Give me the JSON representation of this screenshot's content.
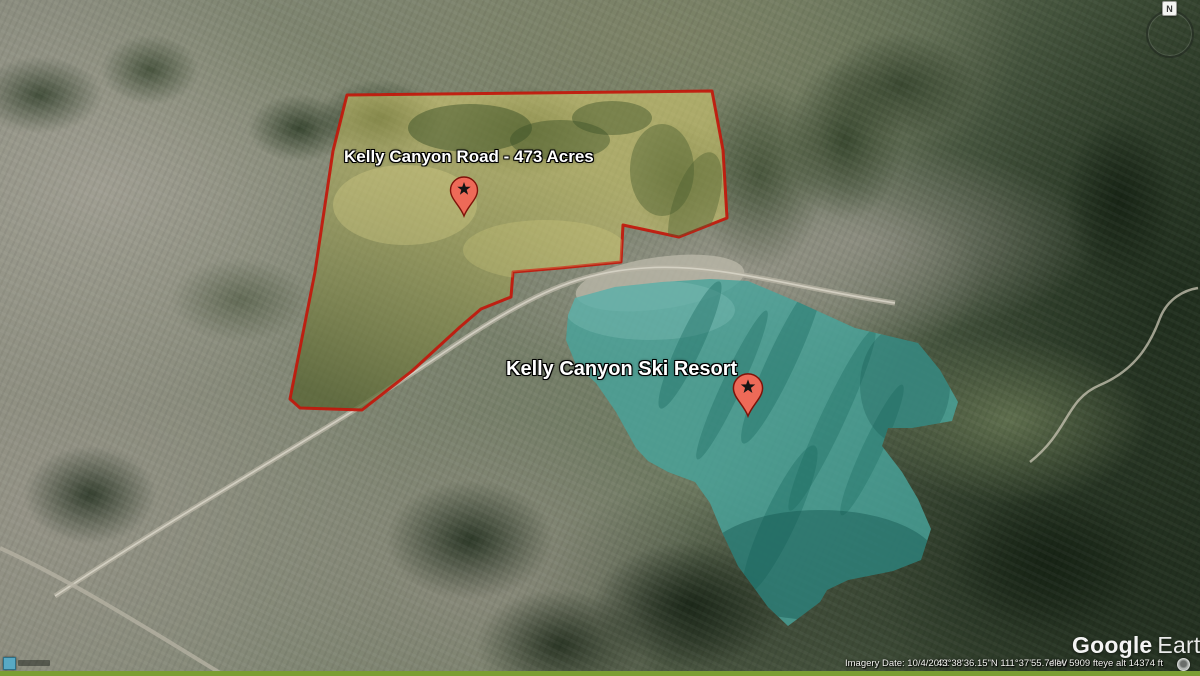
{
  "parcels": [
    {
      "id": "kelly-canyon-road",
      "label": "Kelly Canyon Road - 473 Acres",
      "fill_color": "#dcd26e",
      "shadow_color": "#55622e",
      "border_color": "#c2170b",
      "pin_color": "#ee6a58"
    },
    {
      "id": "kelly-canyon-ski-resort",
      "label": "Kelly Canyon Ski Resort",
      "fill_color": "#48a49b",
      "border_color": "none",
      "pin_color": "#ee6a58"
    }
  ],
  "watermark": {
    "brand": "Google",
    "product": "Earth"
  },
  "status_bar": {
    "imagery_date": "Imagery Date: 10/4/2021",
    "coordinates": "43°38'36.15\"N  111°37'55.74\"W",
    "elevation": "elev  5909 ft",
    "eye_altitude": "eye alt  14374 ft"
  },
  "compass": {
    "north_label": "N"
  }
}
